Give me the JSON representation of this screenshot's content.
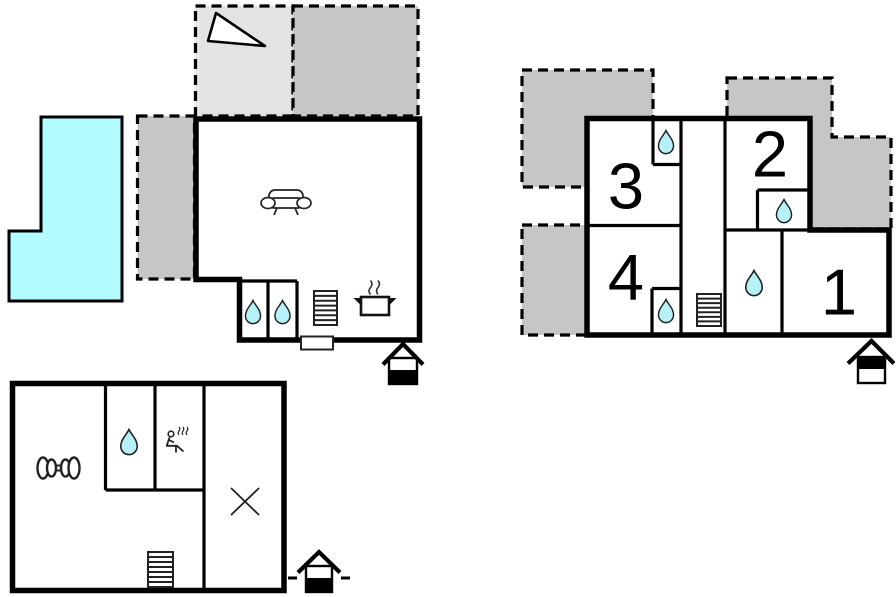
{
  "colors": {
    "wall": "#000000",
    "pool_fill": "#b2fbff",
    "water_drop_fill": "#b6f1f7",
    "terrace_light_fill": "#e3e3e3",
    "terrace_dark_fill": "#c6c6c6"
  },
  "upper_floor": {
    "name": "upper-floor-plan",
    "rooms": [
      {
        "id": "room-3",
        "label": "3"
      },
      {
        "id": "room-2",
        "label": "2"
      },
      {
        "id": "room-4",
        "label": "4"
      },
      {
        "id": "room-1",
        "label": "1"
      }
    ]
  },
  "ground_floor": {
    "name": "ground-floor-plan"
  },
  "basement": {
    "name": "basement-plan"
  },
  "icons": [
    "north-arrow",
    "swimming-pool",
    "terrace",
    "sofa",
    "cooking-pot",
    "stairs",
    "water-drop",
    "window",
    "entrance-house",
    "dumbbell",
    "sauna-person",
    "cross-mark"
  ]
}
